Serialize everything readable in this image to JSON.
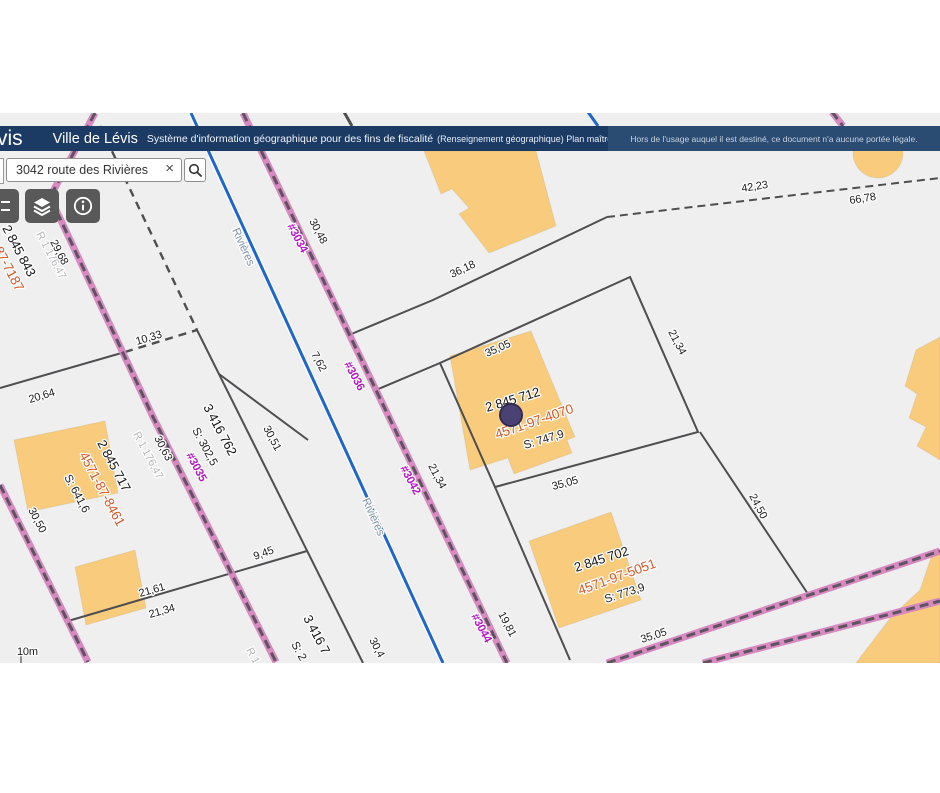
{
  "header": {
    "logo_fragment": "vis",
    "title": "Ville de Lévis",
    "subtitle": "Système d'information géographique pour des fins de fiscalité",
    "subtitle_small": "(Renseignement géographique) Plan maître",
    "disclaimer": "Hors de l'usage auquel il est destiné, ce document n'a aucune portée légale."
  },
  "search": {
    "value": "3042 route des Rivières",
    "clear_icon": "×"
  },
  "toolbar": {
    "buttons": [
      {
        "name": "legend"
      },
      {
        "name": "layers"
      },
      {
        "name": "info"
      }
    ]
  },
  "map": {
    "scale_label": "10m",
    "colors": {
      "header_navy": "#1B3A64",
      "disclaimer_navy": "#2A4B72",
      "road_pink": "#D684BE",
      "road_core": "#5C5460",
      "street_blue": "#1F66CC",
      "building_yellow": "#F8CC7C",
      "parcel_line_gray": "#4E4E50",
      "matricule_orange": "#D55726",
      "civic_magenta": "#B517C8",
      "marker_purple": "#4A4272",
      "map_bg": "#EFEFF0"
    },
    "labels": [
      {
        "t": "2 845 843",
        "x": 2,
        "y": 228,
        "r": 62,
        "c": "lot"
      },
      {
        "t": "4571-87-7187",
        "x": -22,
        "y": 220,
        "r": 62,
        "c": "mat"
      },
      {
        "t": "R 1 176,47",
        "x": 36,
        "y": 234,
        "r": 62,
        "c": "ref"
      },
      {
        "t": "29,68",
        "x": 50,
        "y": 242,
        "r": 62,
        "c": "dim"
      },
      {
        "t": "Rivières",
        "x": 232,
        "y": 230,
        "r": 66,
        "c": "street"
      },
      {
        "t": "Rivières",
        "x": 362,
        "y": 500,
        "r": 66,
        "c": "street"
      },
      {
        "t": "#3034",
        "x": 287,
        "y": 226,
        "r": 62,
        "c": "civ"
      },
      {
        "t": "30,48",
        "x": 309,
        "y": 221,
        "r": 62,
        "c": "dim"
      },
      {
        "t": "42,23",
        "x": 742,
        "y": 192,
        "r": -9,
        "c": "dim"
      },
      {
        "t": "66,78",
        "x": 850,
        "y": 204,
        "r": -9,
        "c": "dim"
      },
      {
        "t": "36,18",
        "x": 452,
        "y": 278,
        "r": -25,
        "c": "dim"
      },
      {
        "t": "10,33",
        "x": 137,
        "y": 345,
        "r": -17,
        "c": "dim"
      },
      {
        "t": "20,64",
        "x": 30,
        "y": 403,
        "r": -17,
        "c": "dim"
      },
      {
        "t": "#3036",
        "x": 344,
        "y": 364,
        "r": 62,
        "c": "civ"
      },
      {
        "t": "7,62",
        "x": 311,
        "y": 354,
        "r": 62,
        "c": "dim"
      },
      {
        "t": "35,05",
        "x": 487,
        "y": 357,
        "r": -24,
        "c": "dim"
      },
      {
        "t": "21,34",
        "x": 668,
        "y": 332,
        "r": 62,
        "c": "dim"
      },
      {
        "t": "2 845 712",
        "x": 487,
        "y": 412,
        "r": -17,
        "c": "lot",
        "fs": 14
      },
      {
        "t": "4571-97-4070",
        "x": 497,
        "y": 439,
        "r": -19,
        "c": "mat",
        "fs": 14.5
      },
      {
        "t": "S: 747,9",
        "x": 525,
        "y": 449,
        "r": -17,
        "c": "area"
      },
      {
        "t": "35,05",
        "x": 553,
        "y": 490,
        "r": -15,
        "c": "dim"
      },
      {
        "t": "21,34",
        "x": 428,
        "y": 466,
        "r": 62,
        "c": "dim"
      },
      {
        "t": "#3042",
        "x": 400,
        "y": 468,
        "r": 62,
        "c": "civ"
      },
      {
        "t": "3 416 762",
        "x": 203,
        "y": 407,
        "r": 62,
        "c": "lot"
      },
      {
        "t": "S: 302,5",
        "x": 192,
        "y": 430,
        "r": 62,
        "c": "area"
      },
      {
        "t": "#3035",
        "x": 186,
        "y": 455,
        "r": 62,
        "c": "civ"
      },
      {
        "t": "30,63",
        "x": 154,
        "y": 438,
        "r": 62,
        "c": "dim"
      },
      {
        "t": "R 1 176,47",
        "x": 133,
        "y": 434,
        "r": 62,
        "c": "ref"
      },
      {
        "t": "30,51",
        "x": 263,
        "y": 428,
        "r": 62,
        "c": "dim"
      },
      {
        "t": "2 845 717",
        "x": 97,
        "y": 443,
        "r": 62,
        "c": "lot"
      },
      {
        "t": "4571-87-8461",
        "x": 79,
        "y": 455,
        "r": 62,
        "c": "mat",
        "fs": 14
      },
      {
        "t": "S: 641,6",
        "x": 64,
        "y": 477,
        "r": 62,
        "c": "area"
      },
      {
        "t": "30,50",
        "x": 28,
        "y": 510,
        "r": 62,
        "c": "dim"
      },
      {
        "t": "9,45",
        "x": 255,
        "y": 560,
        "r": -20,
        "c": "dim"
      },
      {
        "t": "21,61",
        "x": 140,
        "y": 597,
        "r": -16,
        "c": "dim"
      },
      {
        "t": "21,34",
        "x": 150,
        "y": 618,
        "r": -16,
        "c": "dim"
      },
      {
        "t": "2 845 702",
        "x": 576,
        "y": 572,
        "r": -18,
        "c": "lot",
        "fs": 13.5
      },
      {
        "t": "4571-97-5051",
        "x": 580,
        "y": 595,
        "r": -20,
        "c": "mat",
        "fs": 14.5
      },
      {
        "t": "S: 773,9",
        "x": 606,
        "y": 603,
        "r": -18,
        "c": "area"
      },
      {
        "t": "24,50",
        "x": 749,
        "y": 496,
        "r": 62,
        "c": "dim"
      },
      {
        "t": "19,81",
        "x": 498,
        "y": 614,
        "r": 62,
        "c": "dim"
      },
      {
        "t": "#3044",
        "x": 471,
        "y": 616,
        "r": 62,
        "c": "civ"
      },
      {
        "t": "35,05",
        "x": 642,
        "y": 643,
        "r": -18,
        "c": "dim"
      },
      {
        "t": "3 416 7",
        "x": 303,
        "y": 618,
        "r": 62,
        "c": "lot"
      },
      {
        "t": "S: 2",
        "x": 291,
        "y": 644,
        "r": 62,
        "c": "area"
      },
      {
        "t": "30,4",
        "x": 369,
        "y": 640,
        "r": 62,
        "c": "dim"
      },
      {
        "t": "R 1",
        "x": 246,
        "y": 650,
        "r": 62,
        "c": "ref"
      },
      {
        "t": "10m",
        "x": 17,
        "y": 655,
        "r": 0,
        "c": "dim"
      }
    ]
  }
}
